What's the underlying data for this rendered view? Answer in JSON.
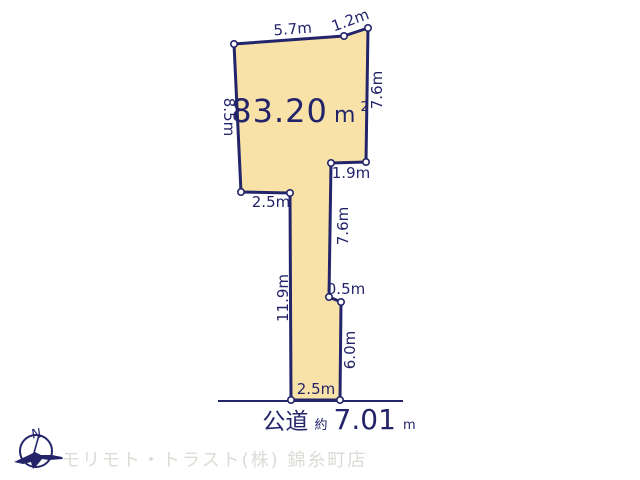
{
  "colors": {
    "navy": "#23246a",
    "parcel_fill": "#f8e2a8",
    "dot_fill": "#ffffff",
    "watermark_gray": "#dcdbd6",
    "background": "#ffffff"
  },
  "parcel": {
    "area_value": "83.20",
    "area_unit": "m",
    "area_unit_sup": "2",
    "edge_labels": {
      "top": "5.7m",
      "top_right": "1.2m",
      "right_upper": "7.6m",
      "notch_right": "1.9m",
      "right_middle": "7.6m",
      "notch_left": "2.5m",
      "left_upper": "8.5m",
      "left_lower": "11.9m",
      "step_right": "0.5m",
      "right_lower": "6.0m",
      "bottom": "2.5m"
    }
  },
  "road": {
    "name": "公道",
    "approx_label": "約",
    "width_value": "7.01",
    "width_unit": "m"
  },
  "compass": {
    "north_label": "N"
  },
  "footer": {
    "watermark": "モリモト・トラスト(株) 錦糸町店"
  }
}
